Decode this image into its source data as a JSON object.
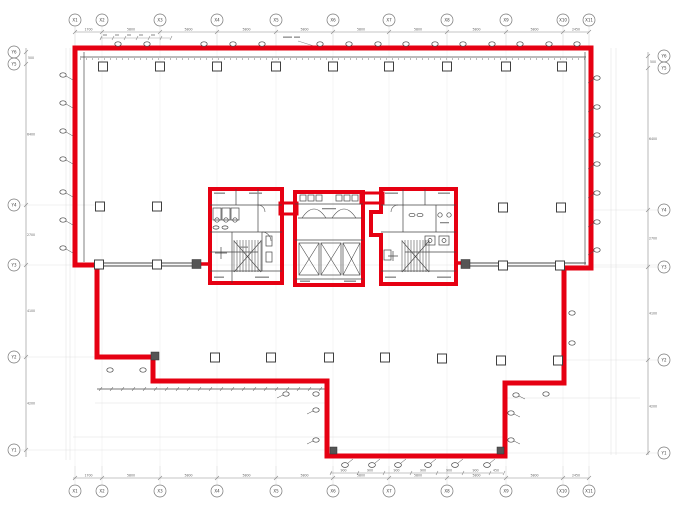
{
  "drawing": {
    "kind_label": "typical floor plan (scanned architectural drawing)",
    "highlighted_region_label": "leased area outline"
  },
  "grid": {
    "x_top": [
      "X1",
      "X2",
      "X3",
      "X4",
      "X5",
      "X6",
      "X7",
      "X8",
      "X9",
      "X10",
      "X11"
    ],
    "x_bottom": [
      "X1",
      "X2",
      "X3",
      "X4",
      "X5",
      "X6",
      "X7",
      "X8",
      "X9",
      "X10",
      "X11"
    ],
    "y_left": [
      "Y6",
      "Y5",
      "Y4",
      "Y3",
      "Y2",
      "Y1"
    ],
    "y_right": [
      "Y6",
      "Y5",
      "Y4",
      "Y3",
      "Y2",
      "Y1"
    ]
  },
  "dimensions": {
    "top": [
      "1700",
      "5800",
      "5800",
      "5800",
      "5800",
      "5800",
      "5800",
      "5800",
      "5800",
      "2450"
    ],
    "bottom": [
      "1700",
      "5800",
      "5800",
      "5800",
      "5800",
      "5800",
      "5800",
      "5800",
      "5800",
      "2450"
    ],
    "left": [
      "500",
      "6400",
      "2700",
      "4100",
      "4200"
    ],
    "right": [
      "500",
      "6400",
      "2700",
      "4100",
      "4200"
    ],
    "sub_bottom": [
      "900",
      "900",
      "900",
      "900",
      "900",
      "900",
      "450"
    ]
  },
  "colors": {
    "highlight_red": "#e60012",
    "line_dark": "#3f3f3f",
    "line_mid": "#777777",
    "line_light": "#b5b5b5",
    "paper": "#ffffff"
  }
}
